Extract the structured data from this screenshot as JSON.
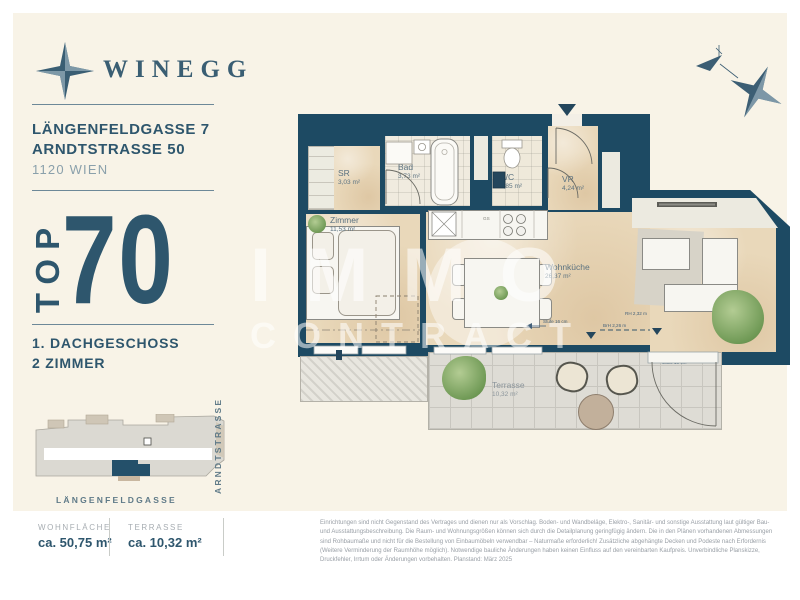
{
  "brand": {
    "name": "WINEGG"
  },
  "header": {
    "address_line1": "LÄNGENFELDGASSE 7",
    "address_line2": "ARNDTSTRASSE 50",
    "city": "1120 WIEN"
  },
  "unit": {
    "top_label": "TOP",
    "top_number": "70",
    "floor": "1. DACHGESCHOSS",
    "rooms": "2 ZIMMER"
  },
  "site_plan": {
    "street_bottom": "LÄNGENFELDGASSE",
    "street_right": "ARNDTSTRASSE"
  },
  "floor_plan": {
    "rooms": {
      "sr": {
        "name": "SR",
        "area": "3,03 m²"
      },
      "bad": {
        "name": "Bad",
        "area": "3,73 m²"
      },
      "wc": {
        "name": "WC",
        "area": "1,85 m²"
      },
      "vr": {
        "name": "VR",
        "area": "4,24 m²"
      },
      "zimmer": {
        "name": "Zimmer",
        "area": "11,53 m²"
      },
      "wohnkueche": {
        "name": "Wohnküche",
        "area": "26,37 m²"
      },
      "terrasse": {
        "name": "Terrasse",
        "area": "10,32 m²"
      }
    },
    "fixtures": {
      "wm": "WM",
      "gs": "GS"
    },
    "annotations": {
      "stufe_left": "Stufe 16 cm",
      "stufe_door": "Stufe 16 cm",
      "rh": "RH 2,32 m",
      "brh": "BrH 2,26 m"
    },
    "watermark_line1": "IMMO",
    "watermark_line2": "CONTRACT"
  },
  "summary": {
    "wohnflaeche": {
      "label": "WOHNFLÄCHE",
      "value": "ca. 50,75 m²"
    },
    "terrasse": {
      "label": "TERRASSE",
      "value": "ca. 10,32 m²"
    }
  },
  "disclaimer": "Einrichtungen sind nicht Gegenstand des Vertrages und dienen nur als Vorschlag. Boden- und Wandbeläge, Elektro-, Sanitär- und sonstige Ausstattung laut gültiger Bau- und Ausstattungsbeschreibung. Die Raum- und Wohnungsgrößen können sich durch die Detailplanung geringfügig ändern. Die in den Plänen vorhandenen Abmessungen sind Rohbaumaße und nicht für die Bestellung von Einbaumöbeln verwendbar – Naturmaße erforderlich! Zusätzliche abgehängte Decken und Podeste nach Erfordernis (Weitere Verminderung der Raumhöhe möglich). Notwendige bauliche Änderungen haben keinen Einfluss auf den vereinbarten Kaufpreis. Unverbindliche Planskizze, Druckfehler, Irrtum oder Änderungen vorbehalten. Planstand: März 2025",
  "colors": {
    "wall": "#1d4a63",
    "accent_text": "#2e566d",
    "floor_beige": "#e9d8ba",
    "cream_background": "#f8f3e7"
  }
}
